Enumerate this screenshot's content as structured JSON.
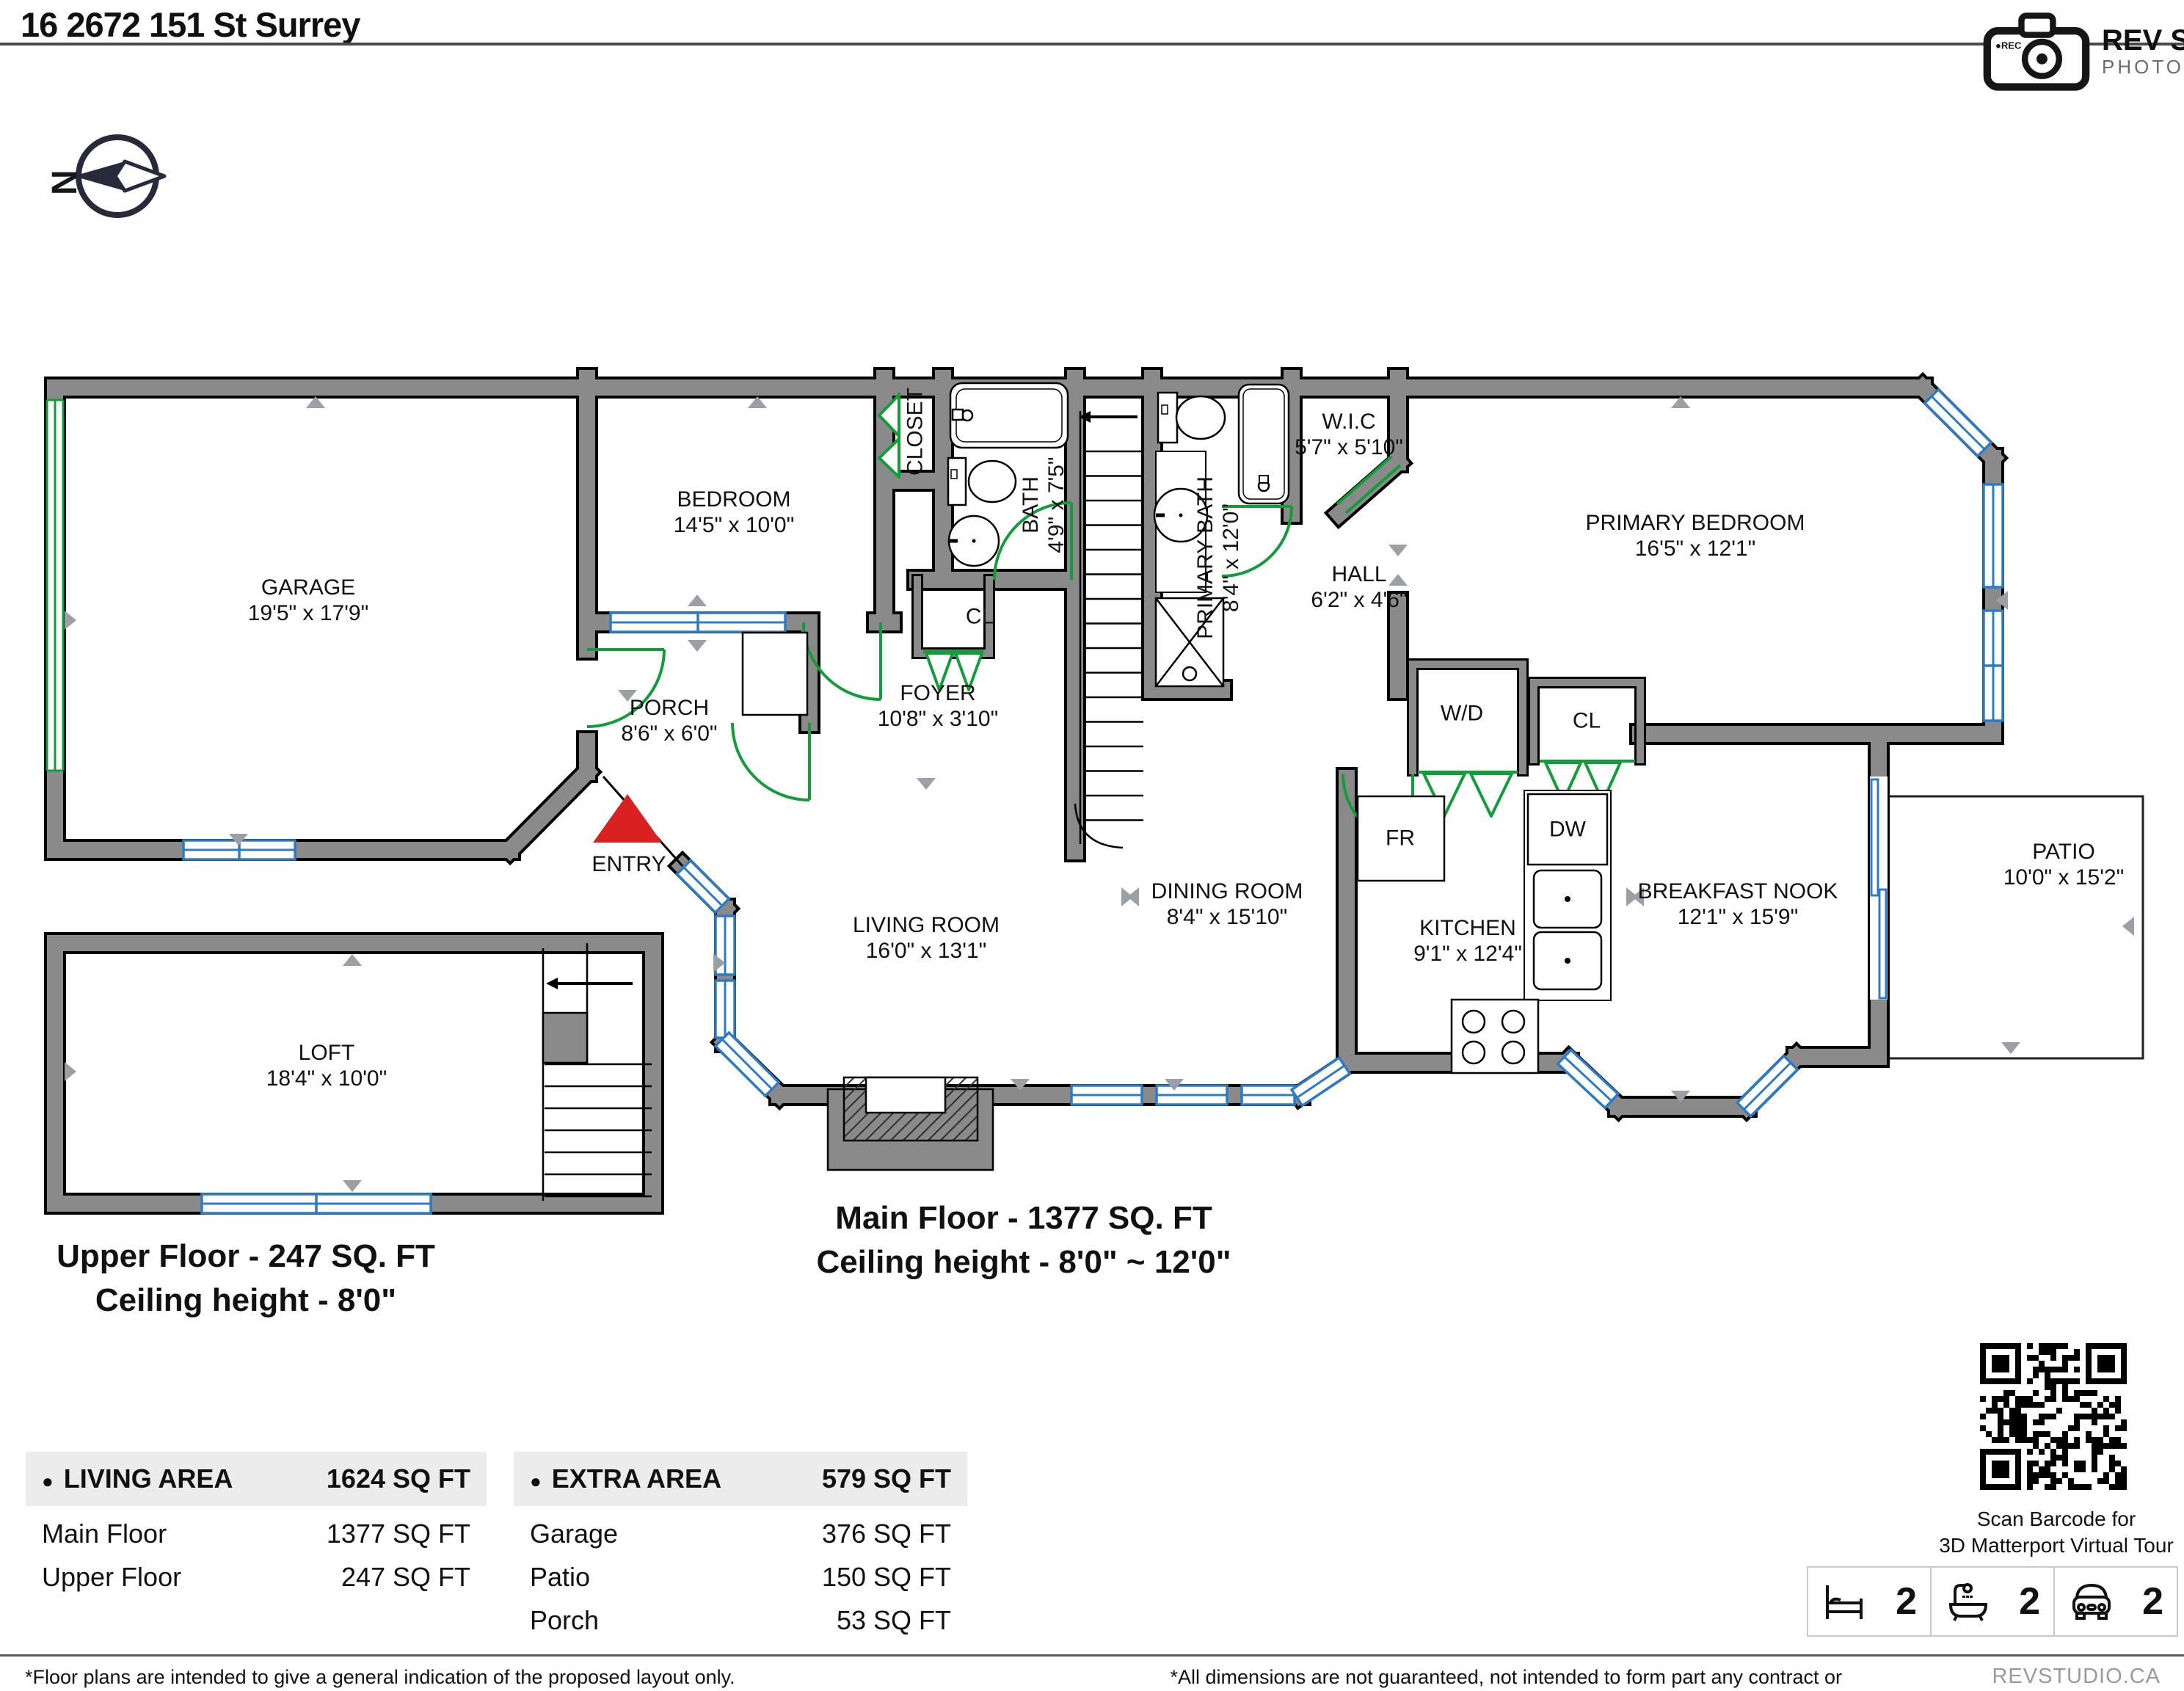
{
  "header": {
    "title": "16 2672 151 St Surrey",
    "logo_name": "REV STUDIO",
    "logo_sub": "PHOTOGRAPHY",
    "logo_rec": "REC"
  },
  "compass": {
    "north_label": "N"
  },
  "floors": {
    "upper": {
      "line1": "Upper Floor - 247 SQ. FT",
      "line2": "Ceiling height - 8'0\""
    },
    "main": {
      "line1": "Main Floor - 1377 SQ. FT",
      "line2": "Ceiling height - 8'0\" ~ 12'0\""
    }
  },
  "rooms": {
    "garage": {
      "name": "GARAGE",
      "dims": "19'5\" x 17'9\""
    },
    "bedroom": {
      "name": "BEDROOM",
      "dims": "14'5\" x 10'0\""
    },
    "closet": {
      "name": "CLOSET"
    },
    "bath": {
      "name": "BATH",
      "dims": "4'9\" x 7'5\""
    },
    "foyer": {
      "name": "FOYER",
      "dims": "10'8\" x 3'10\""
    },
    "cl_foyer": {
      "name": "CL"
    },
    "porch": {
      "name": "PORCH",
      "dims": "8'6\" x 6'0\""
    },
    "primary_bath": {
      "name": "PRIMARY BATH",
      "dims": "8'4\" x 12'0\""
    },
    "wic": {
      "name": "W.I.C",
      "dims": "5'7\" x 5'10\""
    },
    "hall": {
      "name": "HALL",
      "dims": "6'2\" x 4'6\""
    },
    "wd": {
      "name": "W/D"
    },
    "cl_hall": {
      "name": "CL"
    },
    "primary_bedroom": {
      "name": "PRIMARY BEDROOM",
      "dims": "16'5\" x 12'1\""
    },
    "kitchen": {
      "name": "KITCHEN",
      "dims": "9'1\" x 12'4\""
    },
    "dining": {
      "name": "DINING ROOM",
      "dims": "8'4\" x 15'10\""
    },
    "living": {
      "name": "LIVING ROOM",
      "dims": "16'0\" x 13'1\""
    },
    "nook": {
      "name": "BREAKFAST NOOK",
      "dims": "12'1\" x 15'9\""
    },
    "patio": {
      "name": "PATIO",
      "dims": "10'0\" x 15'2\""
    },
    "loft": {
      "name": "LOFT",
      "dims": "18'4\" x 10'0\""
    },
    "entry": {
      "name": "ENTRY"
    },
    "fridge_label": "FR",
    "dishwasher_label": "DW"
  },
  "tables": {
    "living_area": {
      "header": "LIVING AREA",
      "total": "1624 SQ FT",
      "rows": [
        {
          "label": "Main Floor",
          "value": "1377 SQ FT"
        },
        {
          "label": "Upper Floor",
          "value": "247 SQ FT"
        }
      ]
    },
    "extra_area": {
      "header": "EXTRA AREA",
      "total": "579 SQ FT",
      "rows": [
        {
          "label": "Garage",
          "value": "376 SQ FT"
        },
        {
          "label": "Patio",
          "value": "150 SQ FT"
        },
        {
          "label": "Porch",
          "value": "53 SQ FT"
        }
      ]
    }
  },
  "qr": {
    "caption_line1": "Scan Barcode for",
    "caption_line2": "3D Matterport Virtual Tour"
  },
  "stats": [
    {
      "icon": "bed-icon",
      "value": "2"
    },
    {
      "icon": "bath-icon",
      "value": "2"
    },
    {
      "icon": "car-icon",
      "value": "2"
    }
  ],
  "footer": {
    "left": "*Floor plans are intended to give a general indication of the proposed layout only.",
    "center": "*All dimensions are not guaranteed, not intended to form part any contract or warranty.",
    "right": "REVSTUDIO.CA"
  },
  "colors": {
    "wall": "#8a8a8a",
    "window": "#2e7bc4",
    "door": "#129c3a",
    "entry_marker": "#d92121",
    "dim_marker": "#9aa0a6"
  }
}
